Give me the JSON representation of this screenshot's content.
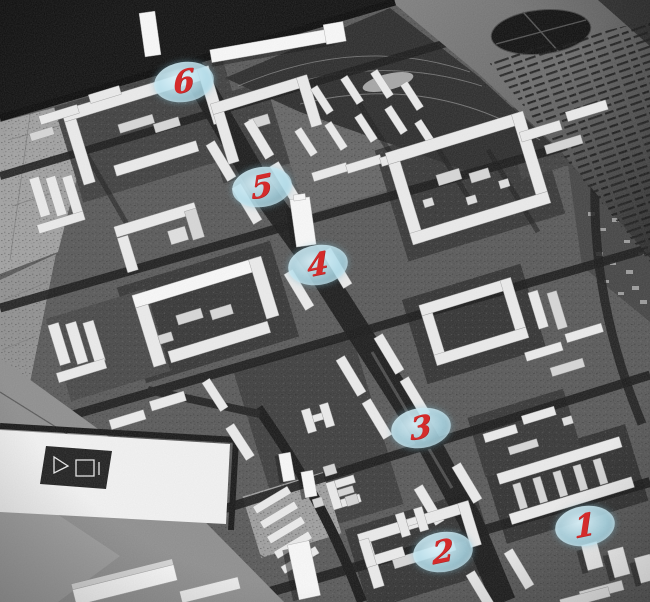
{
  "photo": {
    "alt": "Black-and-white aerial photograph of an architectural city model with white model buildings along a wide diagonal avenue, annotated with six numbered location markers"
  },
  "markers": [
    {
      "label": "1",
      "x_pct": 90.0,
      "y_pct": 87.4
    },
    {
      "label": "2",
      "x_pct": 68.2,
      "y_pct": 91.7
    },
    {
      "label": "3",
      "x_pct": 64.8,
      "y_pct": 71.1
    },
    {
      "label": "4",
      "x_pct": 48.9,
      "y_pct": 44.0
    },
    {
      "label": "5",
      "x_pct": 40.3,
      "y_pct": 31.1
    },
    {
      "label": "6",
      "x_pct": 28.3,
      "y_pct": 13.6
    }
  ],
  "marker_style": {
    "bubble_color": "#aedbe9",
    "number_color": "#d42b2b"
  }
}
